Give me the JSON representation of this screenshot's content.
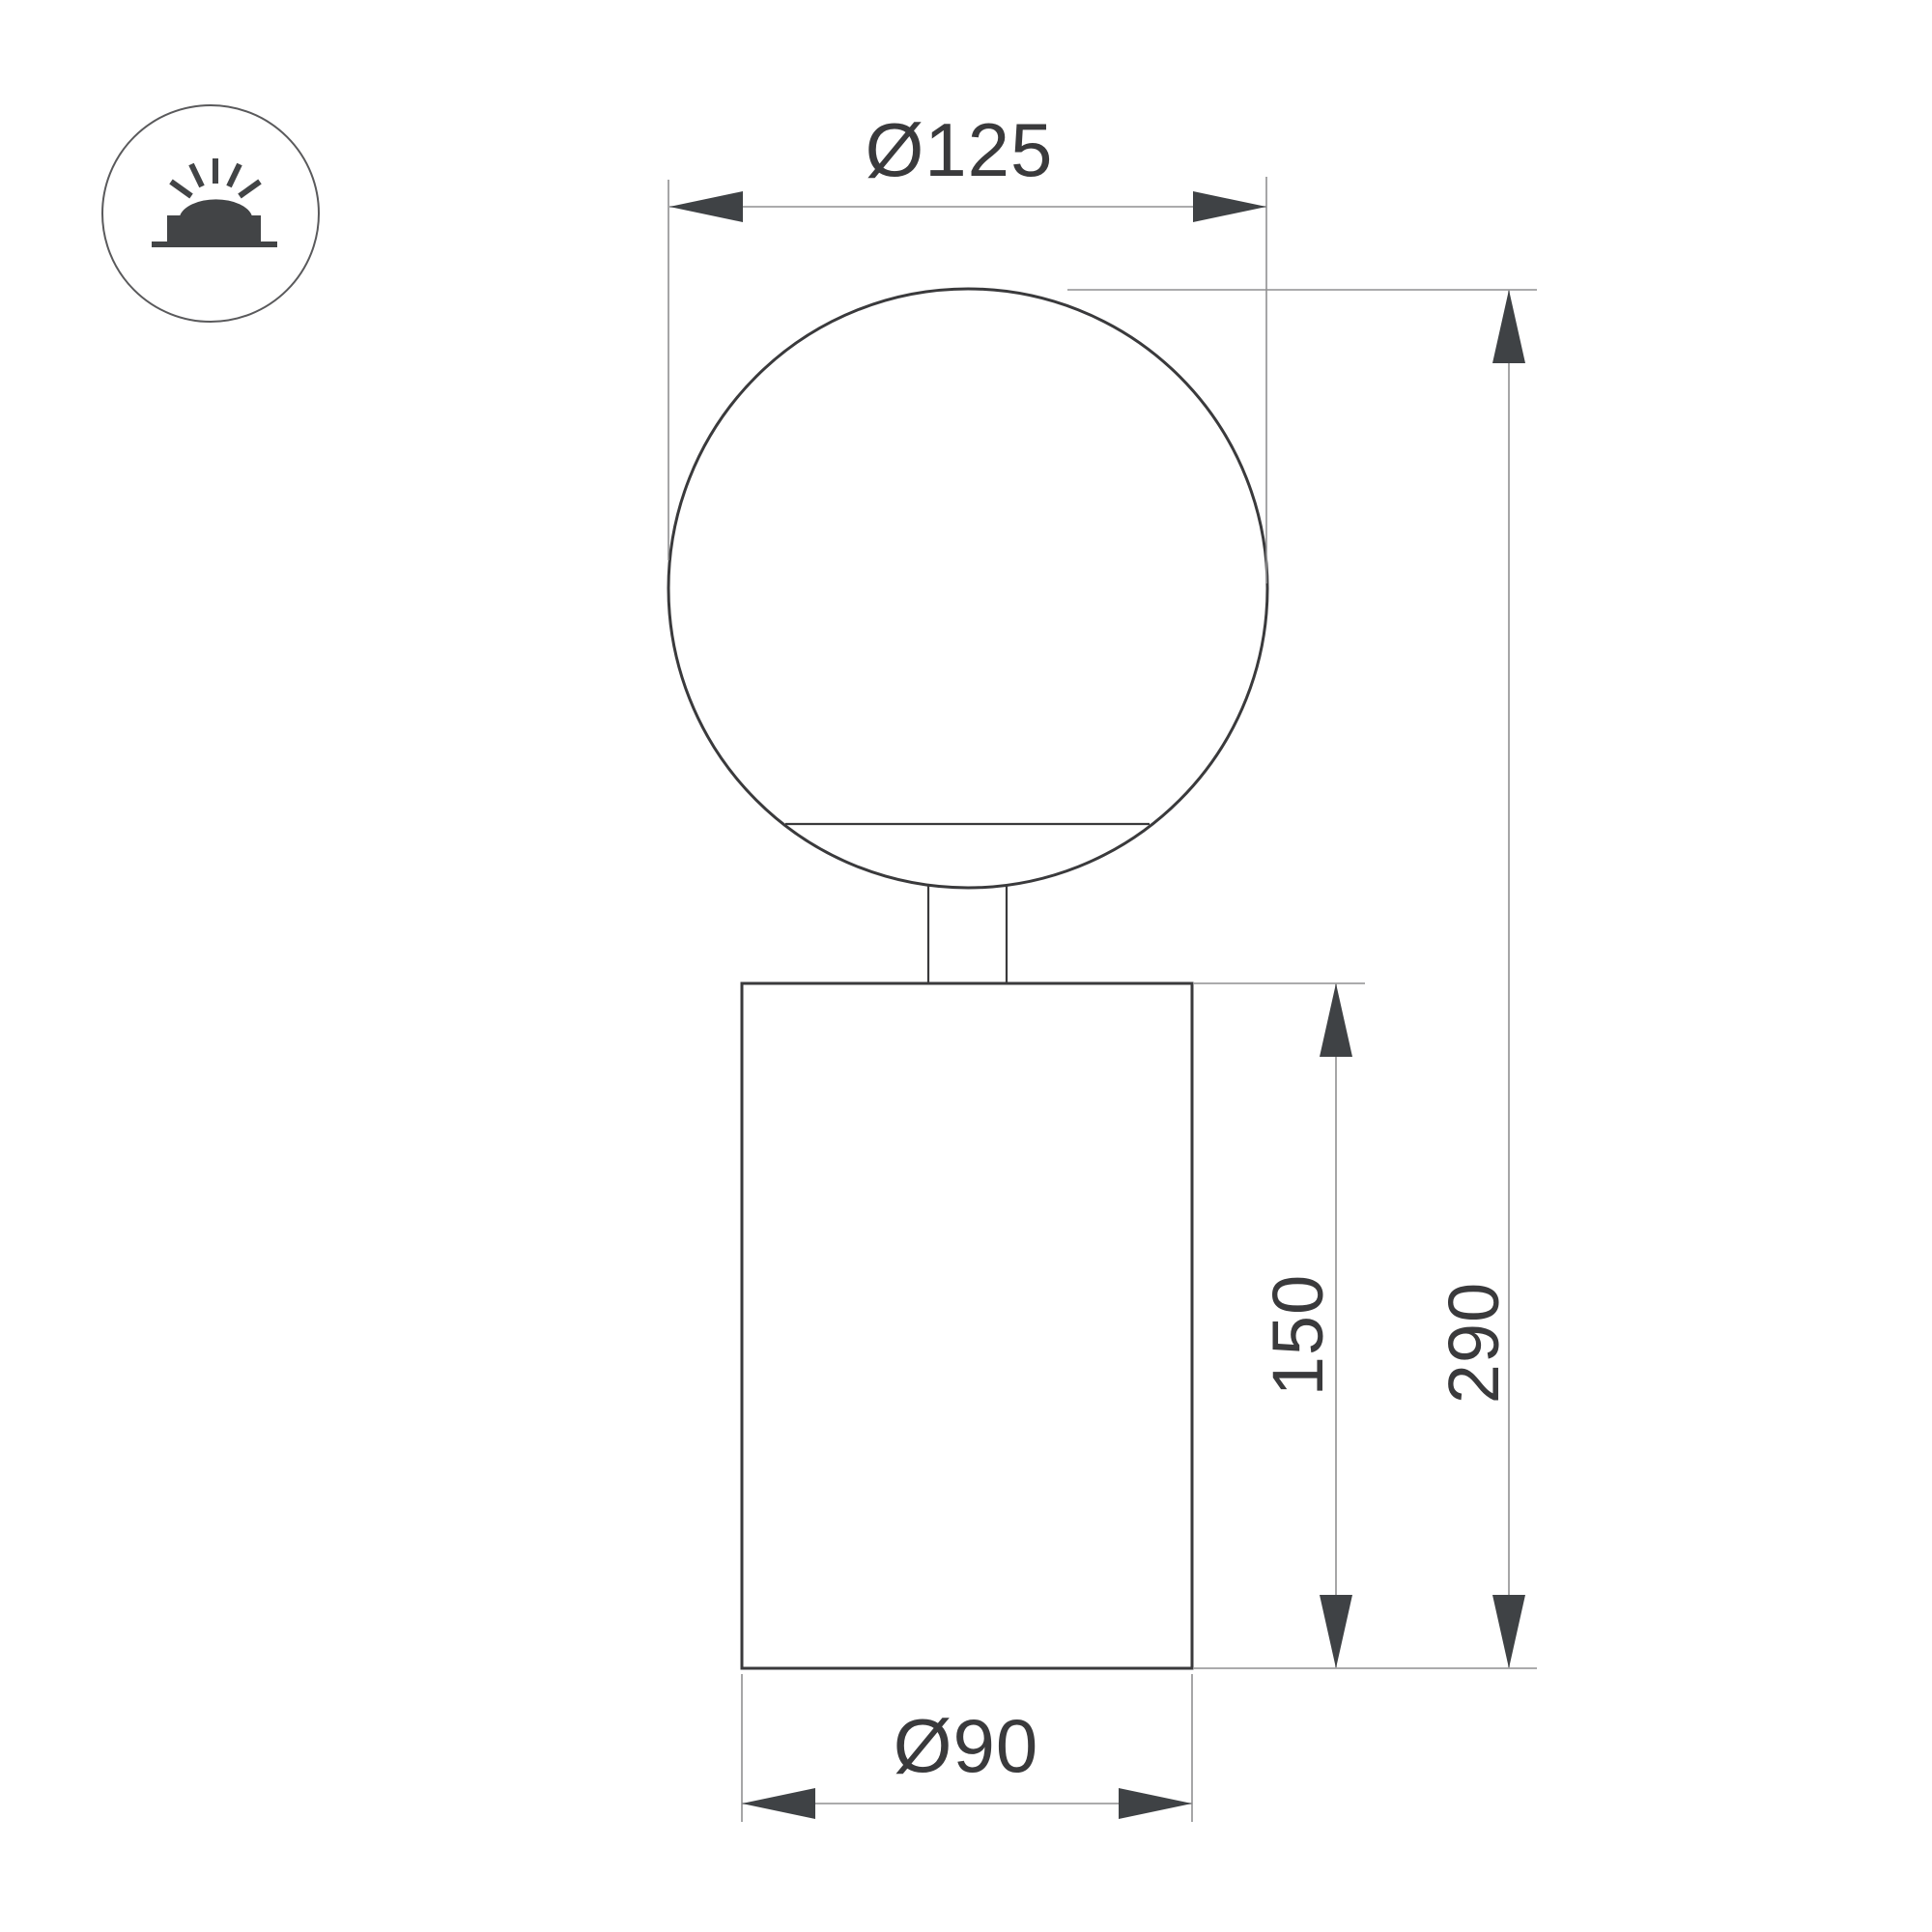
{
  "page": {
    "type": "technical-dimension-drawing",
    "background": "#ffffff"
  },
  "colors": {
    "outline": "#3a3a3c",
    "dimension_line": "#8f8f91",
    "arrowhead": "#3f4245",
    "dimension_text": "#3a3a3c",
    "icon_glyph": "#424446",
    "icon_ring": "#5a5a5c"
  },
  "icon": {
    "name": "surface-mounted-luminaire-icon",
    "shape": "circle outline containing a dome lamp on a mounting base with five light rays"
  },
  "dimensions": {
    "globe_diameter_label": "Ø125",
    "globe_diameter_value": 125,
    "overall_height_label": "290",
    "overall_height_value": 290,
    "body_height_label": "150",
    "body_height_value": 150,
    "body_diameter_label": "Ø90",
    "body_diameter_value": 90
  }
}
